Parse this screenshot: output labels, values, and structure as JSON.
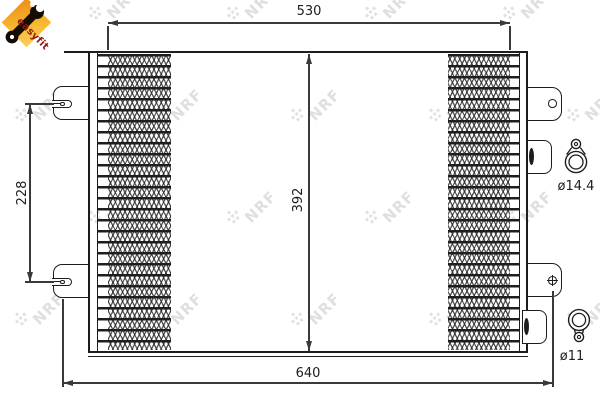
{
  "brand": {
    "watermark_text": "NRF",
    "logo_label": "easyfit"
  },
  "dimensions": {
    "core_width_top": "530",
    "overall_width_bottom": "640",
    "core_height": "392",
    "bracket_spacing": "228"
  },
  "fittings": {
    "top_diameter": "ø14.4",
    "bottom_diameter": "ø11"
  },
  "colors": {
    "line": "#1d1d1b",
    "dimension_line": "#3a3a38",
    "logo_orange_dark": "#f0931a",
    "logo_orange_light": "#fbca5a",
    "logo_text_red": "#8d1b12",
    "watermark_gray": "#c9c6c2",
    "background": "#ffffff"
  }
}
